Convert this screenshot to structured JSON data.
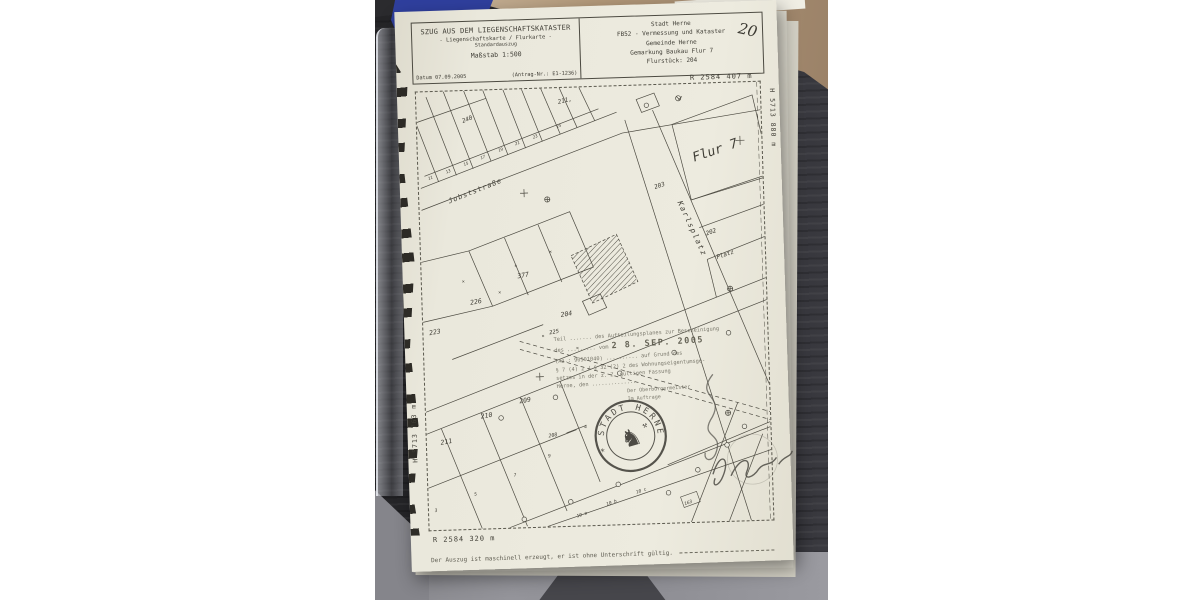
{
  "document": {
    "header_left": {
      "title": "SZUG AUS DEM LIEGENSCHAFTSKATASTER",
      "subtitle": "- Liegenschaftskarte / Flurkarte -",
      "subtype": "Standardauszug",
      "scale": "Maßstab 1:500",
      "date": "Datum 07.09.2005",
      "request_no": "(Antrag-Nr.: E1-1236)"
    },
    "header_right": {
      "city": "Stadt Herne",
      "department": "FB52 - Vermessung und Kataster",
      "municipality": "Gemeinde Herne",
      "district": "Gemarkung Baukau Flur 7",
      "parcel": "Flurstück: 204",
      "handwritten_note": "20"
    },
    "coordinates": {
      "top_right": "R 2584 407 m",
      "right_vertical": "H 5713 880 m",
      "left_vertical": "H 5713 763 m",
      "bottom_left": "R 2584 320 m"
    },
    "certification": {
      "line1": "Teil ....... des Aufteilungsplanes zur Bescheinigung",
      "line2_prefix": "des ......... vom",
      "date_stamp": "2 8. SEP. 2005",
      "line3": "(Az.: 90501040) .......... auf Grund des",
      "line4": "§ 7 (4) 2 / § 32 (2) 2 des Wohnungseigentumsge-",
      "line5": "setzes in der z. Z. gültigen Fassung",
      "line6": "Herne, den ...............",
      "line7": "Der Oberbürgermeister",
      "line8": "Im Auftrage",
      "seal_text": "* STADT HERNE *",
      "seal_horse_glyph": "♞",
      "seal_hammers_glyph": "⚒"
    },
    "footer": "Der Auszug ist maschinell erzeugt, er ist ohne Unterschrift gültig.",
    "map_labels": {
      "jobststrasse": "Jobststraße",
      "karlsplatz": "Karlsplatz",
      "flur7": "Flur 7",
      "platz": "Platz",
      "p203": "203",
      "p202": "202",
      "p240": "240",
      "p211_top": "211,",
      "p226": "226",
      "p223": "223",
      "p225": "225",
      "p377": "377",
      "p204": "204",
      "p211": "211",
      "p210": "210",
      "p209": "209",
      "p208": "208",
      "p163": "163",
      "h11": "11",
      "h13": "13",
      "h15": "15",
      "h17": "17",
      "h19": "19",
      "h21": "21",
      "h23": "23",
      "h25": "25",
      "h3": "3",
      "h5": "5",
      "h7": "7",
      "h9": "9",
      "h4": "4",
      "h10a": "10 a",
      "h10b": "10 b",
      "h10c": "10 c",
      "x_mark": "×"
    },
    "colors": {
      "paper": "#eae8dc",
      "desk": "#2b2b2e",
      "blue_fabric": "#2f3f9d",
      "wood_floor": "#b29879",
      "concrete_floor": "#8f8f93",
      "ink": "#3f3d35",
      "stamp_gray": "#716f63"
    }
  }
}
